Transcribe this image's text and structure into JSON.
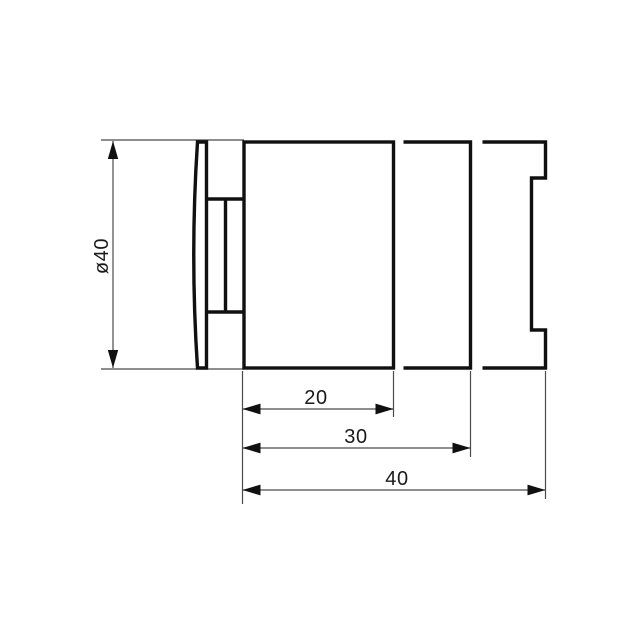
{
  "page": {
    "background": "#ffffff"
  },
  "drawing": {
    "palette": {
      "outline": "#101010",
      "thin_line": "#4a4a4a",
      "arrow": "#101010",
      "text": "#1a1a1a"
    },
    "dimensions": {
      "diameter": {
        "label": "ø40"
      },
      "depths": [
        {
          "label": "20"
        },
        {
          "label": "30"
        },
        {
          "label": "40"
        }
      ]
    }
  }
}
